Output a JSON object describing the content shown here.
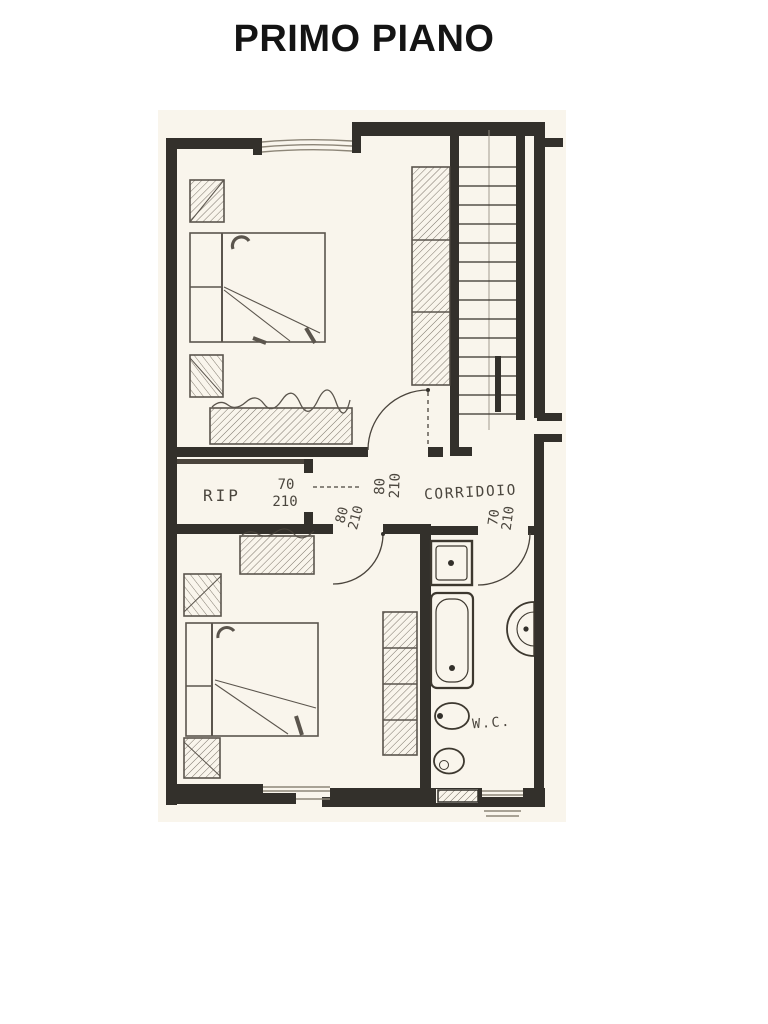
{
  "title": "PRIMO PIANO",
  "labels": {
    "storage": "RIP",
    "corridor": "CORRIDOIO",
    "wc": "W.C."
  },
  "dimensions": {
    "storage_door": {
      "w": "70",
      "h": "210"
    },
    "bedroom1_door": {
      "w": "80",
      "h": "210"
    },
    "bedroom2_door": {
      "w": "80",
      "h": "210"
    },
    "bathroom_door": {
      "w": "70",
      "h": "210"
    }
  },
  "colors": {
    "wall": "#33302b",
    "pencil": "#4a443c",
    "paper": "#f9f5ec"
  }
}
